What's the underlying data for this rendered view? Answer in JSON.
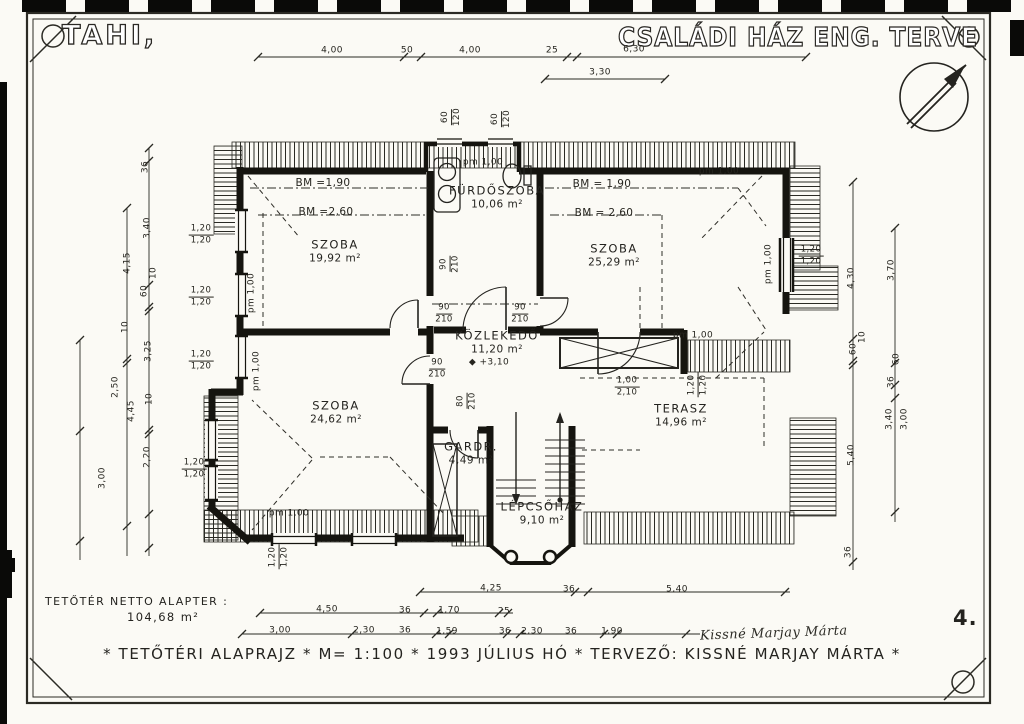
{
  "sheet": {
    "location": "TAHI,",
    "title": "CSALÁDI HÁZ  ENG. TERVE",
    "page_number": "4.",
    "net_area_label": "TETŐTÉR NETTO ALAPTER :",
    "net_area_value": "104,68 m²",
    "footer": "* TETŐTÉRI ALAPRAJZ *  M= 1:100 *  1993 JÚLIUS HÓ *  TERVEZŐ: KISSNÉ MARJAY MÁRTA *",
    "signature": "Kissné Marjay Márta",
    "scale": "1:100",
    "date": "1993 JÚLIUS HÓ",
    "designer": "KISSNÉ MARJAY MÁRTA",
    "drawing_name": "TETŐTÉRI ALAPRAJZ"
  },
  "colors": {
    "paper": "#fbfaf5",
    "ink": "#24231f",
    "artifact": "#0a0a08"
  },
  "plan": {
    "rooms": [
      {
        "name": "SZOBA",
        "area": "19,92 m²",
        "x": 335,
        "y": 251
      },
      {
        "name": "FÜRDŐSZOBA",
        "area": "10,06 m²",
        "x": 497,
        "y": 197
      },
      {
        "name": "SZOBA",
        "area": "25,29 m²",
        "x": 614,
        "y": 255
      },
      {
        "name": "KÖZLEKEDŐ",
        "area": "11,20 m²",
        "x": 497,
        "y": 342
      },
      {
        "name": "SZOBA",
        "area": "24,62 m²",
        "x": 336,
        "y": 412
      },
      {
        "name": "GARDR.",
        "area": "4,49 m²",
        "x": 471,
        "y": 453
      },
      {
        "name": "LÉPCSŐHÁZ",
        "area": "9,10 m²",
        "x": 542,
        "y": 513
      },
      {
        "name": "TERASZ",
        "area": "14,96 m²",
        "x": 681,
        "y": 415
      }
    ],
    "labels": [
      {
        "t": "BM =1,90",
        "x": 323,
        "y": 183,
        "fs": 10.5
      },
      {
        "t": "BM =2,60",
        "x": 326,
        "y": 212,
        "fs": 10.5
      },
      {
        "t": "BM = 1,90",
        "x": 602,
        "y": 184,
        "fs": 10.5
      },
      {
        "t": "BM = 2,60",
        "x": 604,
        "y": 213,
        "fs": 10.5
      },
      {
        "t": "◆ +3,10",
        "x": 489,
        "y": 363
      },
      {
        "t": "4,00",
        "x": 332,
        "y": 51
      },
      {
        "t": "50",
        "x": 407,
        "y": 51
      },
      {
        "t": "4,00",
        "x": 470,
        "y": 51
      },
      {
        "t": "25",
        "x": 552,
        "y": 51
      },
      {
        "t": "6,30",
        "x": 634,
        "y": 50
      },
      {
        "t": "3,30",
        "x": 600,
        "y": 73
      },
      {
        "t": "60",
        "t2": "120",
        "x": 452,
        "y": 117,
        "r": -90
      },
      {
        "t": "60",
        "t2": "120",
        "x": 502,
        "y": 119,
        "r": -90
      },
      {
        "t": "36",
        "x": 146,
        "y": 167,
        "r": -90
      },
      {
        "t": "3,40",
        "x": 148,
        "y": 228,
        "r": -90
      },
      {
        "t": "10",
        "x": 154,
        "y": 273,
        "r": -90
      },
      {
        "t": "60",
        "x": 145,
        "y": 291,
        "r": -90
      },
      {
        "t": "4,15",
        "x": 128,
        "y": 263,
        "r": -90
      },
      {
        "t": "10",
        "x": 126,
        "y": 327,
        "r": -90
      },
      {
        "t": "3,25",
        "x": 149,
        "y": 351,
        "r": -90
      },
      {
        "t": "4,45",
        "x": 132,
        "y": 411,
        "r": -90
      },
      {
        "t": "2,50",
        "x": 116,
        "y": 387,
        "r": -90
      },
      {
        "t": "10",
        "x": 150,
        "y": 399,
        "r": -90
      },
      {
        "t": "2,20",
        "x": 148,
        "y": 457,
        "r": -90
      },
      {
        "t": "3,00",
        "x": 103,
        "y": 478,
        "r": -90
      },
      {
        "t": "4,30",
        "x": 852,
        "y": 278,
        "r": -90
      },
      {
        "t": "3,70",
        "x": 892,
        "y": 270,
        "r": -90
      },
      {
        "t": "10",
        "x": 863,
        "y": 337,
        "r": -90
      },
      {
        "t": "60",
        "x": 854,
        "y": 349,
        "r": -90
      },
      {
        "t": "60",
        "x": 897,
        "y": 359,
        "r": -90
      },
      {
        "t": "36",
        "x": 892,
        "y": 382,
        "r": -90
      },
      {
        "t": "3,40",
        "x": 890,
        "y": 419,
        "r": -90
      },
      {
        "t": "3,00",
        "x": 905,
        "y": 419,
        "r": -90
      },
      {
        "t": "5,40",
        "x": 852,
        "y": 455,
        "r": -90
      },
      {
        "t": "36",
        "x": 849,
        "y": 552,
        "r": -90
      },
      {
        "t": "4,25",
        "x": 491,
        "y": 589
      },
      {
        "t": "36",
        "x": 569,
        "y": 590
      },
      {
        "t": "5,40",
        "x": 677,
        "y": 590
      },
      {
        "t": "4,50",
        "x": 327,
        "y": 610
      },
      {
        "t": "36",
        "x": 405,
        "y": 611
      },
      {
        "t": "1,70",
        "x": 449,
        "y": 611
      },
      {
        "t": "25",
        "x": 504,
        "y": 612
      },
      {
        "t": "3,00",
        "x": 280,
        "y": 631
      },
      {
        "t": "2,30",
        "x": 364,
        "y": 631
      },
      {
        "t": "36",
        "x": 405,
        "y": 631
      },
      {
        "t": "1,59",
        "x": 447,
        "y": 632
      },
      {
        "t": "36",
        "x": 505,
        "y": 632
      },
      {
        "t": "2,30",
        "x": 532,
        "y": 632
      },
      {
        "t": "36",
        "x": 571,
        "y": 632
      },
      {
        "t": "1,90",
        "x": 612,
        "y": 632
      },
      {
        "t": "pm  1,00",
        "x": 483,
        "y": 163
      },
      {
        "t": "pm  1,00",
        "x": 719,
        "y": 172
      },
      {
        "t": "pm  1,00",
        "x": 252,
        "y": 293,
        "r": -90
      },
      {
        "t": "pm  1,00",
        "x": 257,
        "y": 371,
        "r": -90
      },
      {
        "t": "pm  1,00",
        "x": 289,
        "y": 514
      },
      {
        "t": "pm  1,00",
        "x": 693,
        "y": 336
      },
      {
        "t": "pm  1,00",
        "x": 769,
        "y": 264,
        "r": -90
      },
      {
        "t": "1,20",
        "t2": "1,20",
        "x": 201,
        "y": 235,
        "fs": 8.5
      },
      {
        "t": "1,20",
        "t2": "1,20",
        "x": 201,
        "y": 297,
        "fs": 8.5
      },
      {
        "t": "1,20",
        "t2": "1,20",
        "x": 201,
        "y": 361,
        "fs": 8.5
      },
      {
        "t": "1,20",
        "t2": "1,20",
        "x": 194,
        "y": 469,
        "fs": 8.5
      },
      {
        "t": "1,20",
        "t2": "1,20",
        "x": 279,
        "y": 557,
        "r": -90,
        "fs": 8.5
      },
      {
        "t": "1,20",
        "t2": "1,20",
        "x": 811,
        "y": 256,
        "fs": 8.5
      },
      {
        "t": "1,20",
        "t2": "1,20",
        "x": 698,
        "y": 385,
        "r": -90,
        "fs": 8.5
      },
      {
        "t": "90",
        "t2": "210",
        "x": 450,
        "y": 264,
        "r": -90,
        "fs": 8.5
      },
      {
        "t": "90",
        "t2": "210",
        "x": 444,
        "y": 314,
        "fs": 8.5
      },
      {
        "t": "90",
        "t2": "210",
        "x": 437,
        "y": 369,
        "fs": 8.5
      },
      {
        "t": "90",
        "t2": "210",
        "x": 520,
        "y": 314,
        "fs": 8.5
      },
      {
        "t": "80",
        "t2": "210",
        "x": 467,
        "y": 401,
        "r": -90,
        "fs": 8.5
      },
      {
        "t": "1,00",
        "t2": "2,10",
        "x": 627,
        "y": 387,
        "fs": 8.5
      }
    ]
  }
}
